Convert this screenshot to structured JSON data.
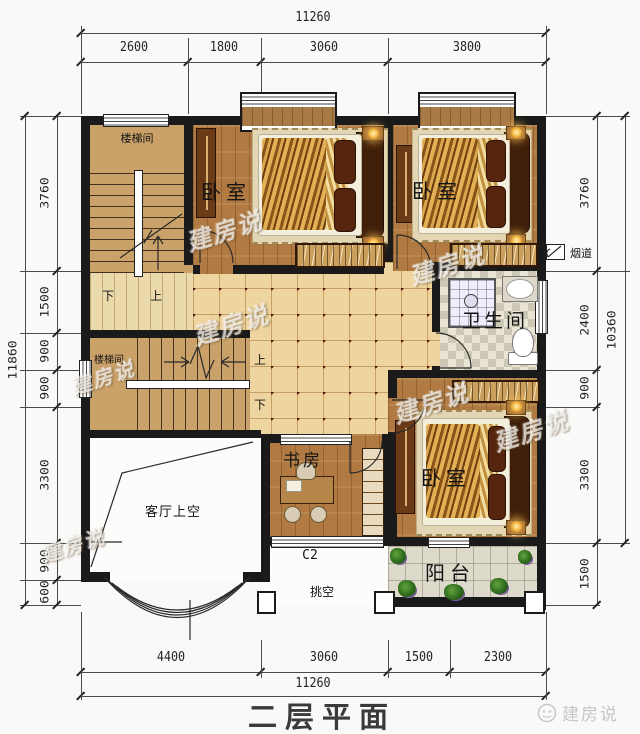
{
  "title": "二层平面",
  "brand": {
    "name": "建房说",
    "watermark": "建房说"
  },
  "dimensions": {
    "top": {
      "total": "11260",
      "segments": [
        "2600",
        "1800",
        "3060",
        "3800"
      ]
    },
    "bottom": {
      "total": "11260",
      "segments": [
        "4400",
        "3060",
        "1500",
        "2300"
      ]
    },
    "left": {
      "total": "11860",
      "segments": [
        "3760",
        "1500",
        "900",
        "900",
        "3300",
        "900",
        "600"
      ]
    },
    "right": {
      "total": "10360",
      "segments": [
        "3760",
        "2400",
        "900",
        "3300",
        "1500"
      ]
    }
  },
  "rooms": {
    "stairwell_top": "楼梯间",
    "stairwell_mid": "楼梯间",
    "bedroom_top_mid": "卧室",
    "bedroom_top_right": "卧室",
    "bedroom_bottom_right": "卧室",
    "bathroom": "卫生间",
    "study": "书房",
    "living_void": "客厅上空",
    "balcony": "阳台"
  },
  "annotations": {
    "flue": "烟道",
    "window_code": "C2",
    "cantilever": "挑空",
    "stair1_down": "下",
    "stair1_up": "上",
    "stair2_up": "上",
    "stair2_down": "下"
  },
  "colors": {
    "wall": "#1a1a1a",
    "wood_floor": "#b07a42",
    "stair_floor": "#c9a169",
    "hall_tile": "#eed49e",
    "tile_dot": "#4f170b",
    "bathroom_tile": "#cdc8b6",
    "balcony_tile": "#dedacb",
    "bed_blanket": "#d9a84e",
    "dim_text": "#222222",
    "logo_gray": "#c9c9c9"
  }
}
